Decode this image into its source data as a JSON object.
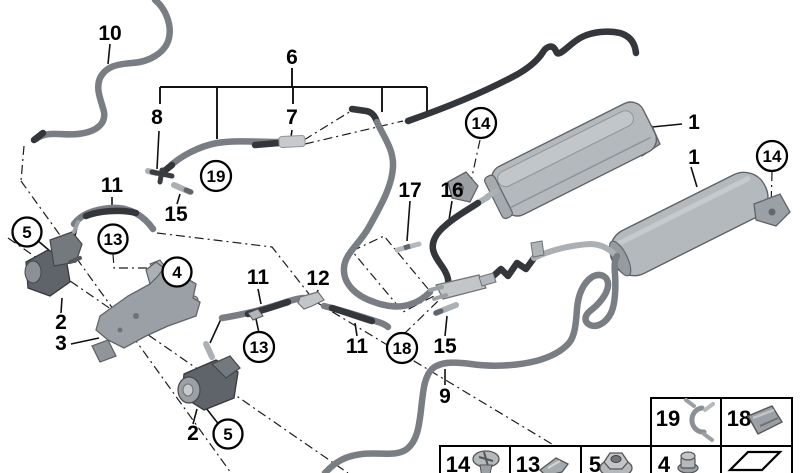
{
  "diagram": {
    "type": "vehicle-parts-diagram",
    "background_color": "#ffffff",
    "line_color": "#000000",
    "hose_color": "#787e84",
    "hose_dark_color": "#33373b",
    "part_color": "#b4b9bd",
    "labels": {
      "l10": "10",
      "l6": "6",
      "l8": "8",
      "l7": "7",
      "l11a": "11",
      "l15a": "15",
      "l17": "17",
      "l16": "16",
      "l1a": "1",
      "l1b": "1",
      "l11b": "11",
      "l12": "12",
      "l2a": "2",
      "l3": "3",
      "l11c": "11",
      "l15b": "15",
      "l2b": "2",
      "l9": "9"
    },
    "callouts": {
      "c5a": "5",
      "c13a": "13",
      "c4": "4",
      "c19": "19",
      "c14a": "14",
      "c14b": "14",
      "c13b": "13",
      "c18": "18",
      "c5b": "5"
    },
    "legend": {
      "row1": [
        {
          "num": "19",
          "icon": "hose-clip"
        },
        {
          "num": "18",
          "icon": "spring-clip"
        }
      ],
      "row2": [
        {
          "num": "14",
          "icon": "screw"
        },
        {
          "num": "13",
          "icon": "clip"
        },
        {
          "num": "5",
          "icon": "nut"
        },
        {
          "num": "4",
          "icon": "plug"
        },
        {
          "num": "",
          "icon": "continuation-arrow"
        }
      ]
    }
  }
}
